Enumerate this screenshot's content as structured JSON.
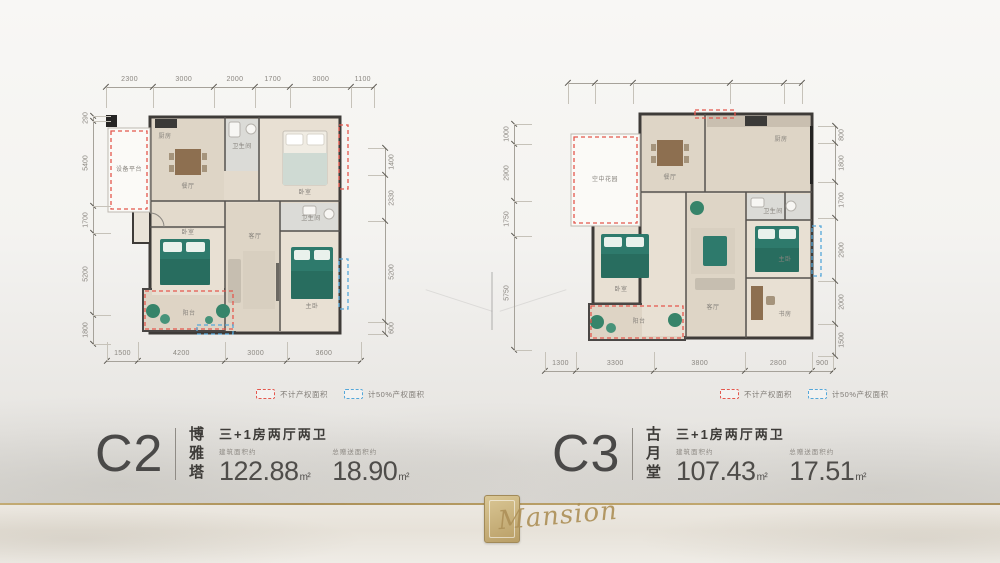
{
  "page": {
    "background": "#f3f2ef",
    "gold": "#b2975e"
  },
  "units": [
    {
      "code": "C2",
      "name": "博雅塔",
      "layout_type": "三+1房两厅两卫",
      "areas": [
        {
          "label": "建筑面积约",
          "value": "122.88",
          "unit": "m²"
        },
        {
          "label": "总赠送面积约",
          "value": "18.90",
          "unit": "m²"
        }
      ],
      "legend": [
        {
          "color": "#e4574d",
          "label": "不计产权面积"
        },
        {
          "color": "#55a7d9",
          "label": "计50%产权面积"
        }
      ],
      "dims": {
        "top": [
          2300,
          3000,
          2000,
          1700,
          3000,
          1100
        ],
        "bottom": [
          1500,
          4200,
          3000,
          3600
        ],
        "left": [
          290,
          5400,
          1700,
          5200,
          1800
        ],
        "right": [
          1400,
          2330,
          5200,
          600
        ]
      },
      "rooms": [
        {
          "name": "设备平台",
          "x": 24,
          "y": 57
        },
        {
          "name": "厨房",
          "x": 60,
          "y": 24
        },
        {
          "name": "餐厅",
          "x": 83,
          "y": 74
        },
        {
          "name": "卫生间",
          "x": 137,
          "y": 34
        },
        {
          "name": "卧室",
          "x": 200,
          "y": 80
        },
        {
          "name": "卧室",
          "x": 83,
          "y": 120
        },
        {
          "name": "客厅",
          "x": 150,
          "y": 124
        },
        {
          "name": "卫生间",
          "x": 206,
          "y": 106
        },
        {
          "name": "主卧",
          "x": 207,
          "y": 194
        },
        {
          "name": "阳台",
          "x": 84,
          "y": 201
        }
      ]
    },
    {
      "code": "C3",
      "name": "古月堂",
      "layout_type": "三+1房两厅两卫",
      "areas": [
        {
          "label": "建筑面积约",
          "value": "107.43",
          "unit": "m²"
        },
        {
          "label": "总赠送面积约",
          "value": "17.51",
          "unit": "m²"
        }
      ],
      "legend": [
        {
          "color": "#e4574d",
          "label": "不计产权面积"
        },
        {
          "color": "#55a7d9",
          "label": "计50%产权面积"
        }
      ],
      "dims": {
        "top": [
          800,
          1150,
          2900,
          1600,
          550
        ],
        "bottom": [
          1300,
          3300,
          3800,
          2800,
          900
        ],
        "left": [
          1000,
          2900,
          1750,
          5750
        ],
        "right": [
          800,
          1800,
          1700,
          2900,
          2000,
          1500
        ]
      },
      "rooms": [
        {
          "name": "空中花园",
          "x": 60,
          "y": 72
        },
        {
          "name": "餐厅",
          "x": 125,
          "y": 70
        },
        {
          "name": "厨房",
          "x": 236,
          "y": 32
        },
        {
          "name": "卫生间",
          "x": 228,
          "y": 104
        },
        {
          "name": "卧室",
          "x": 76,
          "y": 182
        },
        {
          "name": "客厅",
          "x": 168,
          "y": 200
        },
        {
          "name": "主卧",
          "x": 240,
          "y": 152
        },
        {
          "name": "书房",
          "x": 240,
          "y": 207
        },
        {
          "name": "阳台",
          "x": 94,
          "y": 214
        }
      ]
    }
  ],
  "footer": {
    "brand_script": "Mansion"
  }
}
